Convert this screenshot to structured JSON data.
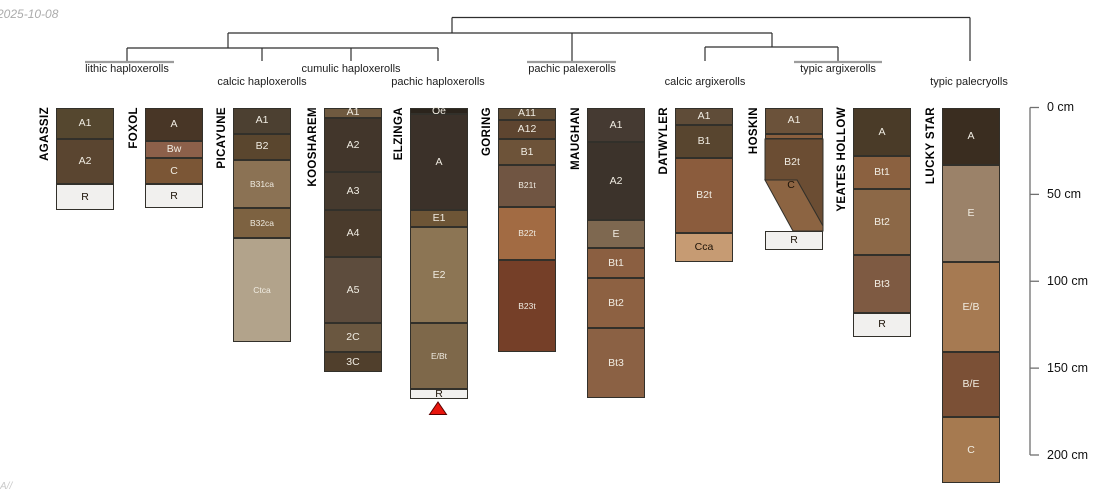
{
  "date_stamp": "2025-10-08",
  "watermark": "A//",
  "palette": {
    "dendro_line": "#2e2e2e",
    "leaf_bar": "#9c9c9c",
    "axis_line": "#707070",
    "horizon_border": "#32302a",
    "label_light": "#f0ece2",
    "label_dark": "#1d1308",
    "marker_fill": "#e8150d",
    "marker_stroke": "#5a0000"
  },
  "depth_axis": {
    "x_px": 1030,
    "tick_len_px": 9,
    "top_px": 107.5,
    "px_per_cm": 1.7375,
    "labels": [
      "0 cm",
      "50 cm",
      "100 cm",
      "150 cm",
      "200 cm"
    ],
    "values_cm": [
      0,
      50,
      100,
      150,
      200
    ]
  },
  "dendrogram": {
    "segments": [
      [
        452,
        17.5,
        970,
        17.5
      ],
      [
        970,
        17.5,
        970,
        61
      ],
      [
        452,
        17.5,
        452,
        33
      ],
      [
        228,
        33,
        772,
        33
      ],
      [
        228,
        33,
        228,
        48
      ],
      [
        572,
        33,
        572,
        61
      ],
      [
        772,
        33,
        772,
        47
      ],
      [
        127,
        48,
        438,
        48
      ],
      [
        127,
        48,
        127,
        61
      ],
      [
        262,
        48,
        262,
        61
      ],
      [
        351,
        48,
        351,
        61
      ],
      [
        438,
        48,
        438,
        61
      ],
      [
        705,
        47,
        838,
        47
      ],
      [
        705,
        47,
        705,
        61
      ],
      [
        838,
        47,
        838,
        61
      ]
    ],
    "extent_bars": [
      {
        "x1": 85,
        "x2": 174,
        "y": 62
      },
      {
        "x1": 527,
        "x2": 616,
        "y": 62
      },
      {
        "x1": 794,
        "x2": 882,
        "y": 62
      }
    ],
    "groups": [
      {
        "label": "lithic haploxerolls",
        "cx": 127,
        "row": 1,
        "members": [
          "AGASSIZ",
          "FOXOL"
        ]
      },
      {
        "label": "calcic haploxerolls",
        "cx": 262,
        "row": 2,
        "members": [
          "PICAYUNE"
        ]
      },
      {
        "label": "cumulic haploxerolls",
        "cx": 351,
        "row": 1,
        "members": [
          "KOOSHAREM"
        ]
      },
      {
        "label": "pachic haploxerolls",
        "cx": 438,
        "row": 2,
        "members": [
          "ELZINGA"
        ]
      },
      {
        "label": "pachic palexerolls",
        "cx": 572,
        "row": 1,
        "members": [
          "GORING",
          "MAUGHAN"
        ]
      },
      {
        "label": "calcic argixerolls",
        "cx": 705,
        "row": 2,
        "members": [
          "DATWYLER"
        ]
      },
      {
        "label": "typic argixerolls",
        "cx": 838,
        "row": 1,
        "members": [
          "HOSKIN",
          "YEATES HOLLOW"
        ]
      },
      {
        "label": "typic palecryolls",
        "cx": 969,
        "row": 2,
        "members": [
          "LUCKY STAR"
        ]
      }
    ]
  },
  "marker": {
    "shape": "triangle",
    "below_profile": "ELZINGA",
    "points": "429.5,414.5 446.5,414.5 438,402"
  },
  "chart_data": {
    "type": "soil-profile-sketches-with-dendrogram",
    "depth_unit": "cm",
    "depth_ticks": [
      0,
      50,
      100,
      150,
      200
    ],
    "profiles": [
      {
        "name": "AGASSIZ",
        "group": "lithic haploxerolls",
        "left_px": 56,
        "width_px": 58,
        "horizons": [
          {
            "label": "A1",
            "top": 0,
            "bottom": 18,
            "color": "#55472f",
            "text": "light"
          },
          {
            "label": "A2",
            "top": 18,
            "bottom": 44,
            "color": "#5a4530",
            "text": "light"
          },
          {
            "label": "R",
            "top": 44,
            "bottom": 59,
            "color": "#f1f0ee",
            "text": "dark"
          }
        ]
      },
      {
        "name": "FOXOL",
        "group": "lithic haploxerolls",
        "left_px": 145,
        "width_px": 58,
        "horizons": [
          {
            "label": "A",
            "top": 0,
            "bottom": 19,
            "color": "#483626",
            "text": "light"
          },
          {
            "label": "Bw",
            "top": 19,
            "bottom": 29,
            "color": "#8c604a",
            "text": "light"
          },
          {
            "label": "C",
            "top": 29,
            "bottom": 44,
            "color": "#7b5636",
            "text": "light"
          },
          {
            "label": "R",
            "top": 44,
            "bottom": 58,
            "color": "#f1f0ee",
            "text": "dark"
          }
        ]
      },
      {
        "name": "PICAYUNE",
        "group": "calcic haploxerolls",
        "left_px": 233,
        "width_px": 58,
        "horizons": [
          {
            "label": "A1",
            "top": 0,
            "bottom": 15,
            "color": "#4c4031",
            "text": "light"
          },
          {
            "label": "B2",
            "top": 15,
            "bottom": 30,
            "color": "#5a462e",
            "text": "light"
          },
          {
            "label": "B31ca",
            "top": 30,
            "bottom": 58,
            "color": "#8b7254",
            "text": "light"
          },
          {
            "label": "B32ca",
            "top": 58,
            "bottom": 75,
            "color": "#7d6241",
            "text": "light"
          },
          {
            "label": "Ctca",
            "top": 75,
            "bottom": 135,
            "color": "#b2a38b",
            "text": "light"
          }
        ]
      },
      {
        "name": "KOOSHAREM",
        "group": "cumulic haploxerolls",
        "left_px": 324,
        "width_px": 58,
        "horizons": [
          {
            "label": "A1",
            "top": 0,
            "bottom": 6,
            "color": "#6f5a40",
            "text": "light"
          },
          {
            "label": "A2",
            "top": 6,
            "bottom": 37,
            "color": "#42362b",
            "text": "light"
          },
          {
            "label": "A3",
            "top": 37,
            "bottom": 59,
            "color": "#463a2e",
            "text": "light"
          },
          {
            "label": "A4",
            "top": 59,
            "bottom": 86,
            "color": "#4a3b2c",
            "text": "light"
          },
          {
            "label": "A5",
            "top": 86,
            "bottom": 124,
            "color": "#5d4c3d",
            "text": "light"
          },
          {
            "label": "2C",
            "top": 124,
            "bottom": 141,
            "color": "#6a5740",
            "text": "light"
          },
          {
            "label": "3C",
            "top": 141,
            "bottom": 152,
            "color": "#503f2c",
            "text": "light"
          }
        ]
      },
      {
        "name": "ELZINGA",
        "group": "pachic haploxerolls",
        "left_px": 410,
        "width_px": 58,
        "horizons": [
          {
            "label": "Oe",
            "top": 0,
            "bottom": 4,
            "color": "#2b241c",
            "text": "light"
          },
          {
            "label": "A",
            "top": 4,
            "bottom": 59,
            "color": "#3b3129",
            "text": "light"
          },
          {
            "label": "E1",
            "top": 59,
            "bottom": 69,
            "color": "#6d5536",
            "text": "light"
          },
          {
            "label": "E2",
            "top": 69,
            "bottom": 124,
            "color": "#8c7554",
            "text": "light"
          },
          {
            "label": "E/Bt",
            "top": 124,
            "bottom": 162,
            "color": "#7e684a",
            "text": "light"
          },
          {
            "label": "R",
            "top": 162,
            "bottom": 168,
            "color": "#f1f0ee",
            "text": "dark"
          }
        ]
      },
      {
        "name": "GORING",
        "group": "pachic palexerolls",
        "left_px": 498,
        "width_px": 58,
        "horizons": [
          {
            "label": "A11",
            "top": 0,
            "bottom": 7,
            "color": "#5f4b34",
            "text": "light"
          },
          {
            "label": "A12",
            "top": 7,
            "bottom": 18,
            "color": "#5e4530",
            "text": "light"
          },
          {
            "label": "B1",
            "top": 18,
            "bottom": 33,
            "color": "#6d5339",
            "text": "light"
          },
          {
            "label": "B21t",
            "top": 33,
            "bottom": 57,
            "color": "#705542",
            "text": "light"
          },
          {
            "label": "B22t",
            "top": 57,
            "bottom": 88,
            "color": "#a26b43",
            "text": "light"
          },
          {
            "label": "B23t",
            "top": 88,
            "bottom": 141,
            "color": "#753f28",
            "text": "light"
          }
        ]
      },
      {
        "name": "MAUGHAN",
        "group": "pachic palexerolls",
        "left_px": 587,
        "width_px": 58,
        "horizons": [
          {
            "label": "A1",
            "top": 0,
            "bottom": 20,
            "color": "#453a32",
            "text": "light"
          },
          {
            "label": "A2",
            "top": 20,
            "bottom": 65,
            "color": "#3c332b",
            "text": "light"
          },
          {
            "label": "E",
            "top": 65,
            "bottom": 81,
            "color": "#7e6850",
            "text": "light"
          },
          {
            "label": "Bt1",
            "top": 81,
            "bottom": 98,
            "color": "#8b5f41",
            "text": "light"
          },
          {
            "label": "Bt2",
            "top": 98,
            "bottom": 127,
            "color": "#8d6142",
            "text": "light"
          },
          {
            "label": "Bt3",
            "top": 127,
            "bottom": 167,
            "color": "#8b6144",
            "text": "light"
          }
        ]
      },
      {
        "name": "DATWYLER",
        "group": "calcic argixerolls",
        "left_px": 675,
        "width_px": 58,
        "horizons": [
          {
            "label": "A1",
            "top": 0,
            "bottom": 10,
            "color": "#5f4c38",
            "text": "light"
          },
          {
            "label": "B1",
            "top": 10,
            "bottom": 29,
            "color": "#58452f",
            "text": "light"
          },
          {
            "label": "B2t",
            "top": 29,
            "bottom": 72,
            "color": "#8b5c3d",
            "text": "light"
          },
          {
            "label": "Cca",
            "top": 72,
            "bottom": 89,
            "color": "#c69b73",
            "text": "dark"
          }
        ]
      },
      {
        "name": "HOSKIN",
        "group": "typic argixerolls",
        "left_px": 765,
        "width_px": 58,
        "horizons": [
          {
            "label": "A1",
            "top": 0,
            "bottom": 15,
            "color": "#6b523a",
            "text": "light"
          },
          {
            "label": "",
            "top": 15,
            "bottom": 18,
            "color": "#8a5f3e",
            "text": "light"
          },
          {
            "label": "B2t",
            "top": 18,
            "bottom": 42,
            "color": "#6b4d33",
            "text": "light",
            "poly": [
              [
                765,
                139
              ],
              [
                823,
                139
              ],
              [
                823,
                226
              ],
              [
                797,
                180
              ],
              [
                765,
                180
              ]
            ],
            "label_cx": 792,
            "label_cy": 162
          },
          {
            "label": "C",
            "top": 42,
            "bottom": 71,
            "color": "#8c6442",
            "text": "dark",
            "poly": [
              [
                765,
                180
              ],
              [
                797,
                180
              ],
              [
                823,
                226
              ],
              [
                823,
                231
              ],
              [
                793,
                231
              ]
            ],
            "label_cx": 791,
            "label_cy": 185
          },
          {
            "label": "R",
            "top": 71,
            "bottom": 82,
            "color": "#f1f0ee",
            "text": "dark"
          }
        ]
      },
      {
        "name": "YEATES HOLLOW",
        "group": "typic argixerolls",
        "left_px": 853,
        "width_px": 58,
        "horizons": [
          {
            "label": "A",
            "top": 0,
            "bottom": 28,
            "color": "#4a3b28",
            "text": "light"
          },
          {
            "label": "Bt1",
            "top": 28,
            "bottom": 47,
            "color": "#8b6140",
            "text": "light"
          },
          {
            "label": "Bt2",
            "top": 47,
            "bottom": 85,
            "color": "#8c6847",
            "text": "light"
          },
          {
            "label": "Bt3",
            "top": 85,
            "bottom": 118,
            "color": "#7e5a42",
            "text": "light"
          },
          {
            "label": "R",
            "top": 118,
            "bottom": 132,
            "color": "#f1f0ee",
            "text": "dark"
          }
        ]
      },
      {
        "name": "LUCKY STAR",
        "group": "typic palecryolls",
        "left_px": 942,
        "width_px": 58,
        "horizons": [
          {
            "label": "A",
            "top": 0,
            "bottom": 33,
            "color": "#3a2d20",
            "text": "light"
          },
          {
            "label": "E",
            "top": 33,
            "bottom": 89,
            "color": "#9b8269",
            "text": "light"
          },
          {
            "label": "E/B",
            "top": 89,
            "bottom": 141,
            "color": "#a67a52",
            "text": "light"
          },
          {
            "label": "B/E",
            "top": 141,
            "bottom": 178,
            "color": "#7b5036",
            "text": "light"
          },
          {
            "label": "C",
            "top": 178,
            "bottom": 216,
            "color": "#a67a50",
            "text": "light"
          }
        ]
      }
    ]
  }
}
